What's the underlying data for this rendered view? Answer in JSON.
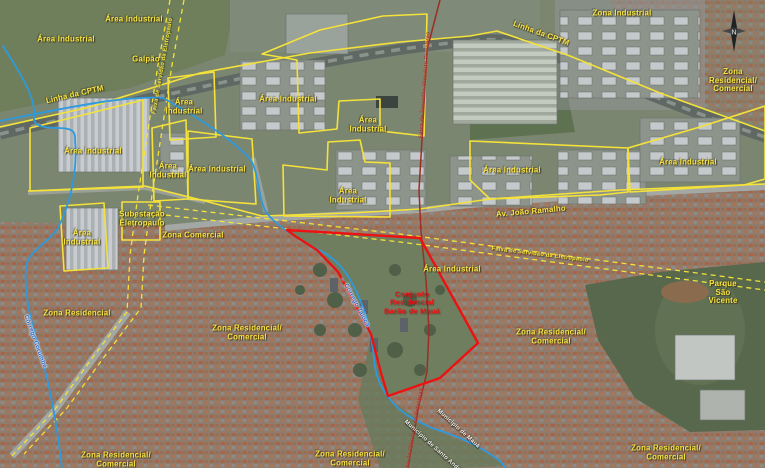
{
  "map": {
    "compass_n": "N",
    "colors": {
      "zone_label_yellow": "#f8e243",
      "zone_outline_yellow": "#f4e23a",
      "site_outline_red": "#ec1212",
      "site_label_red": "#e81414",
      "pipeline_red": "#9c2e24",
      "stream_blue": "#2d9ade",
      "stream_label_blue": "#1f63c8",
      "municipality_label_white": "#f4f4ec"
    },
    "labels": [
      {
        "name": "label-area-industrial-nw1",
        "text": "Área Industrial",
        "x": 134,
        "y": 20,
        "cls": "y"
      },
      {
        "name": "label-area-industrial-nw2",
        "text": "Área Industrial",
        "x": 66,
        "y": 40,
        "cls": "y"
      },
      {
        "name": "label-galpao",
        "text": "Galpão",
        "x": 146,
        "y": 60,
        "cls": "y"
      },
      {
        "name": "label-linha-cptm-west",
        "text": "Linha da CPTM",
        "x": 75,
        "y": 95,
        "r": -13,
        "cls": "y"
      },
      {
        "name": "label-area-industrial-n1",
        "text": "Área\nIndustrial",
        "x": 184,
        "y": 107,
        "cls": "y"
      },
      {
        "name": "label-zona-industrial",
        "text": "Zona Industrial",
        "x": 622,
        "y": 14,
        "cls": "y"
      },
      {
        "name": "label-linha-cptm-east",
        "text": "Linha da CPTM",
        "x": 541,
        "y": 34,
        "r": 20,
        "cls": "y"
      },
      {
        "name": "label-zona-res-com-ne",
        "text": "Zona Residencial/\nComercial",
        "x": 733,
        "y": 81,
        "cls": "y"
      },
      {
        "name": "label-area-industrial-n2",
        "text": "Área Industrial",
        "x": 288,
        "y": 100,
        "cls": "y"
      },
      {
        "name": "label-area-industrial-n3",
        "text": "Área\nIndustrial",
        "x": 368,
        "y": 125,
        "cls": "y"
      },
      {
        "name": "label-area-industrial-w1",
        "text": "Área Industrial",
        "x": 93,
        "y": 152,
        "cls": "y"
      },
      {
        "name": "label-area-industrial-w2",
        "text": "Área\nIndustrial",
        "x": 168,
        "y": 171,
        "cls": "y"
      },
      {
        "name": "label-area-industrial-w3",
        "text": "Área Industrial",
        "x": 217,
        "y": 170,
        "cls": "y"
      },
      {
        "name": "label-subestacao-eletropaulo",
        "text": "Subestação\nEletropaulo",
        "x": 142,
        "y": 219,
        "cls": "y"
      },
      {
        "name": "label-area-industrial-sw",
        "text": "Área\nIndustrial",
        "x": 82,
        "y": 238,
        "cls": "y"
      },
      {
        "name": "label-zona-comercial",
        "text": "Zona Comercial",
        "x": 193,
        "y": 236,
        "cls": "y"
      },
      {
        "name": "label-area-industrial-c",
        "text": "Área\nIndustrial",
        "x": 348,
        "y": 196,
        "cls": "y"
      },
      {
        "name": "label-area-industrial-e1",
        "text": "Área Industrial",
        "x": 512,
        "y": 171,
        "cls": "y"
      },
      {
        "name": "label-area-industrial-e2",
        "text": "Área Industrial",
        "x": 688,
        "y": 163,
        "cls": "y"
      },
      {
        "name": "label-av-joao-ramalho",
        "text": "Av. João Ramalho",
        "x": 531,
        "y": 212,
        "r": -5,
        "cls": "y"
      },
      {
        "name": "label-faixa-eletropaulo-east",
        "text": "Faixa de Servidão da Eletropaulo",
        "x": 540,
        "y": 255,
        "r": 7,
        "cls": "ys"
      },
      {
        "name": "label-faixa-eletropaulo-west",
        "text": "Faixa de Servidão da Eletropaulo",
        "x": 163,
        "y": 66,
        "r": -80,
        "cls": "ys"
      },
      {
        "name": "label-faixa-petrobras-north",
        "text": "Faixa de Servidão Oleoduto Petrobras",
        "x": 425,
        "y": 85,
        "r": -86,
        "cls": "rs"
      },
      {
        "name": "label-faixa-petrobras-south",
        "text": "Faixa do Oleoduto da Petrobras",
        "x": 414,
        "y": 432,
        "r": -80,
        "cls": "rs"
      },
      {
        "name": "label-conjunto-barao-de-maua",
        "text": "Conjunto\nResidencial\nBarão de Mauá",
        "x": 412,
        "y": 303,
        "cls": "r"
      },
      {
        "name": "label-area-industrial-site",
        "text": "Área Industrial",
        "x": 452,
        "y": 270,
        "cls": "y"
      },
      {
        "name": "label-parque-sao-vicente",
        "text": "Parque São Vicente",
        "x": 723,
        "y": 293,
        "cls": "y"
      },
      {
        "name": "label-zona-residencial-w",
        "text": "Zona Residencial",
        "x": 77,
        "y": 314,
        "cls": "y"
      },
      {
        "name": "label-zona-res-com-w",
        "text": "Zona Residencial/\nComercial",
        "x": 247,
        "y": 333,
        "cls": "y"
      },
      {
        "name": "label-zona-res-com-e",
        "text": "Zona Residencial/\nComercial",
        "x": 551,
        "y": 337,
        "cls": "y"
      },
      {
        "name": "label-zona-res-com-sw",
        "text": "Zona Residencial/\nComercial",
        "x": 116,
        "y": 460,
        "cls": "y"
      },
      {
        "name": "label-zona-res-com-s",
        "text": "Zona Residencial/\nComercial",
        "x": 350,
        "y": 459,
        "cls": "y"
      },
      {
        "name": "label-zona-res-com-se",
        "text": "Zona Residencial/\nComercial",
        "x": 666,
        "y": 453,
        "cls": "y"
      },
      {
        "name": "label-corrego-west",
        "text": "← Córrego Corumbé",
        "x": 33,
        "y": 338,
        "r": 70,
        "cls": "b"
      },
      {
        "name": "label-corrego-center",
        "text": "← Córrego Taioca",
        "x": 354,
        "y": 302,
        "r": 62,
        "cls": "b"
      },
      {
        "name": "label-municipio-maua",
        "text": "Município de Mauá",
        "x": 458,
        "y": 429,
        "r": 42,
        "cls": "w"
      },
      {
        "name": "label-municipio-santo-andre",
        "text": "Município de Santo André",
        "x": 433,
        "y": 447,
        "r": 42,
        "cls": "w"
      }
    ]
  }
}
